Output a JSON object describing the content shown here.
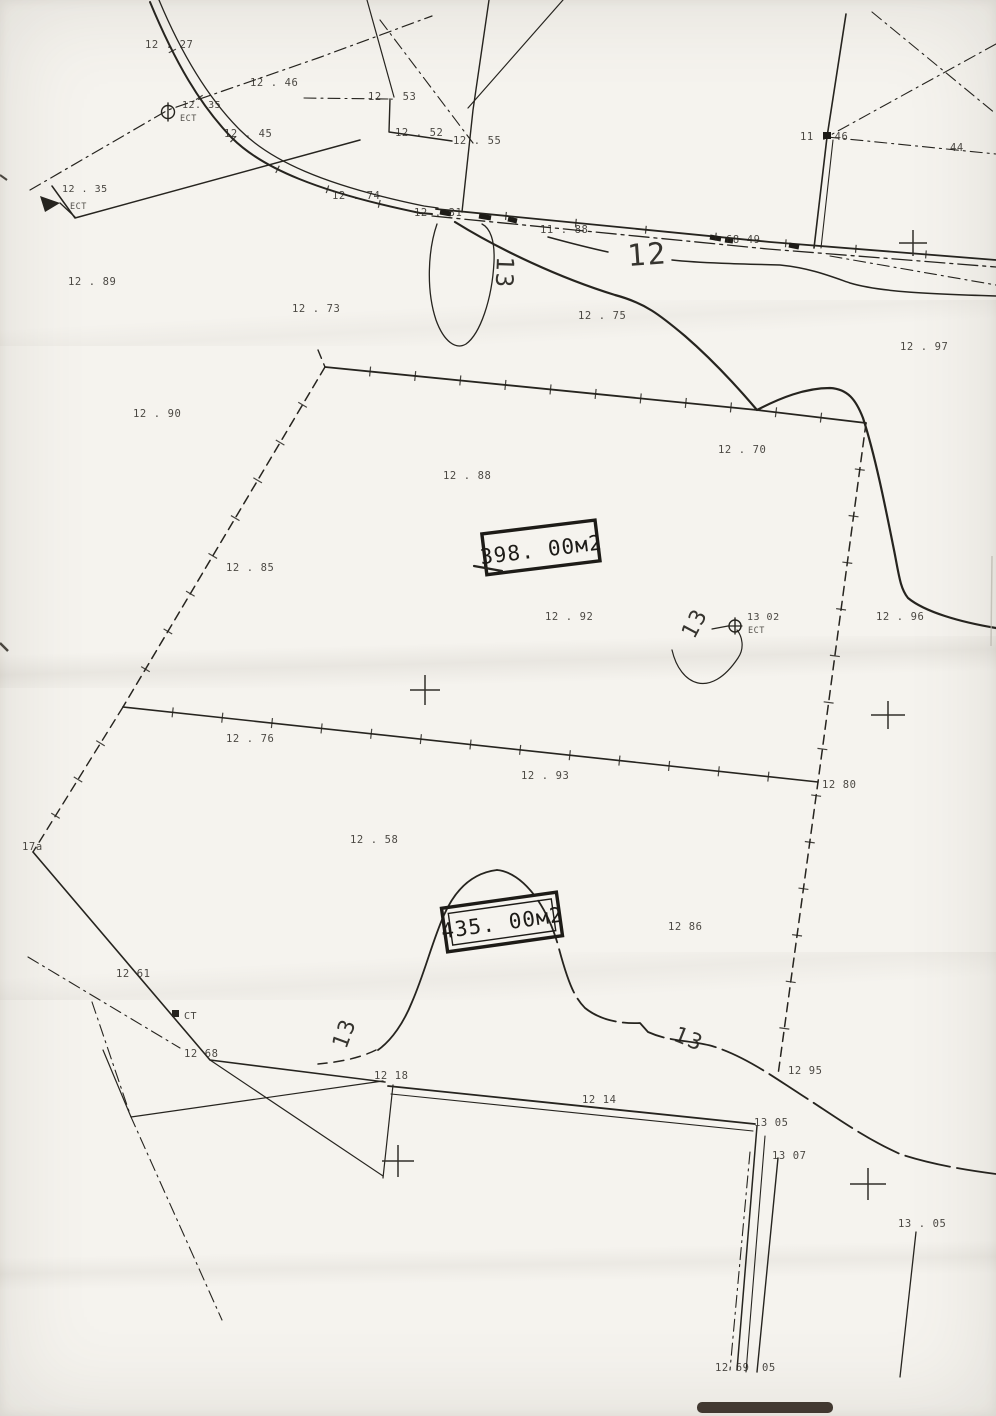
{
  "map": {
    "colors": {
      "ink": "#26241f",
      "paper": "#f5f3ee",
      "scan_bar": "#2a2018"
    },
    "areas": [
      {
        "label": "398. 00м2"
      },
      {
        "label": "435. 00м2"
      }
    ],
    "contour_labels": [
      {
        "text": "12",
        "x": 628,
        "y": 266,
        "rot": -4,
        "size": 30
      },
      {
        "text": "13",
        "x": 497,
        "y": 256,
        "rot": 92,
        "size": 24
      },
      {
        "text": "13",
        "x": 694,
        "y": 640,
        "rot": -62,
        "size": 22
      },
      {
        "text": "13",
        "x": 346,
        "y": 1050,
        "rot": -70,
        "size": 22
      },
      {
        "text": "13",
        "x": 672,
        "y": 1040,
        "rot": 22,
        "size": 22
      }
    ],
    "stations": [
      {
        "label": "12. 35",
        "sub": "ЕСТ"
      },
      {
        "label": "12 . 35",
        "sub": "ЕСТ"
      },
      {
        "label": "13 02",
        "sub": "ЕСТ"
      },
      {
        "label": "СТ",
        "sub": ""
      }
    ],
    "point_labels": [
      {
        "text": "12 . 27",
        "x": 145,
        "y": 48
      },
      {
        "text": "12 . 46",
        "x": 250,
        "y": 86
      },
      {
        "text": "12 . 53",
        "x": 368,
        "y": 100
      },
      {
        "text": "12 . 45",
        "x": 224,
        "y": 137
      },
      {
        "text": "12 . 52",
        "x": 395,
        "y": 136
      },
      {
        "text": "12 . 55",
        "x": 453,
        "y": 144
      },
      {
        "text": "11 . 46",
        "x": 800,
        "y": 140
      },
      {
        "text": "44",
        "x": 950,
        "y": 151
      },
      {
        "text": "12 . 74",
        "x": 332,
        "y": 199
      },
      {
        "text": "12 . 31",
        "x": 414,
        "y": 216
      },
      {
        "text": "11 . 88",
        "x": 540,
        "y": 233
      },
      {
        "text": "68 49",
        "x": 726,
        "y": 243
      },
      {
        "text": "12 . 89",
        "x": 68,
        "y": 285
      },
      {
        "text": "12 . 73",
        "x": 292,
        "y": 312
      },
      {
        "text": "12 . 75",
        "x": 578,
        "y": 319
      },
      {
        "text": "12 . 97",
        "x": 900,
        "y": 350
      },
      {
        "text": "12 . 90",
        "x": 133,
        "y": 417
      },
      {
        "text": "12 . 70",
        "x": 718,
        "y": 453
      },
      {
        "text": "12 . 88",
        "x": 443,
        "y": 479
      },
      {
        "text": "12 . 85",
        "x": 226,
        "y": 571
      },
      {
        "text": "12 . 92",
        "x": 545,
        "y": 620
      },
      {
        "text": "12 . 96",
        "x": 876,
        "y": 620
      },
      {
        "text": "12 . 76",
        "x": 226,
        "y": 742
      },
      {
        "text": "12 . 93",
        "x": 521,
        "y": 779
      },
      {
        "text": "12  80",
        "x": 822,
        "y": 788
      },
      {
        "text": "12 . 58",
        "x": 350,
        "y": 843
      },
      {
        "text": "17а",
        "x": 22,
        "y": 850
      },
      {
        "text": "12  86",
        "x": 668,
        "y": 930
      },
      {
        "text": "12  61",
        "x": 116,
        "y": 977
      },
      {
        "text": "12  68",
        "x": 184,
        "y": 1057
      },
      {
        "text": "12  18",
        "x": 374,
        "y": 1079
      },
      {
        "text": "12  95",
        "x": 788,
        "y": 1074
      },
      {
        "text": "12  14",
        "x": 582,
        "y": 1103
      },
      {
        "text": "13  05",
        "x": 754,
        "y": 1126
      },
      {
        "text": "13  07",
        "x": 772,
        "y": 1159
      },
      {
        "text": "13 . 05",
        "x": 898,
        "y": 1227
      },
      {
        "text": "12  69",
        "x": 715,
        "y": 1371
      },
      {
        "text": "05",
        "x": 762,
        "y": 1371
      }
    ]
  }
}
